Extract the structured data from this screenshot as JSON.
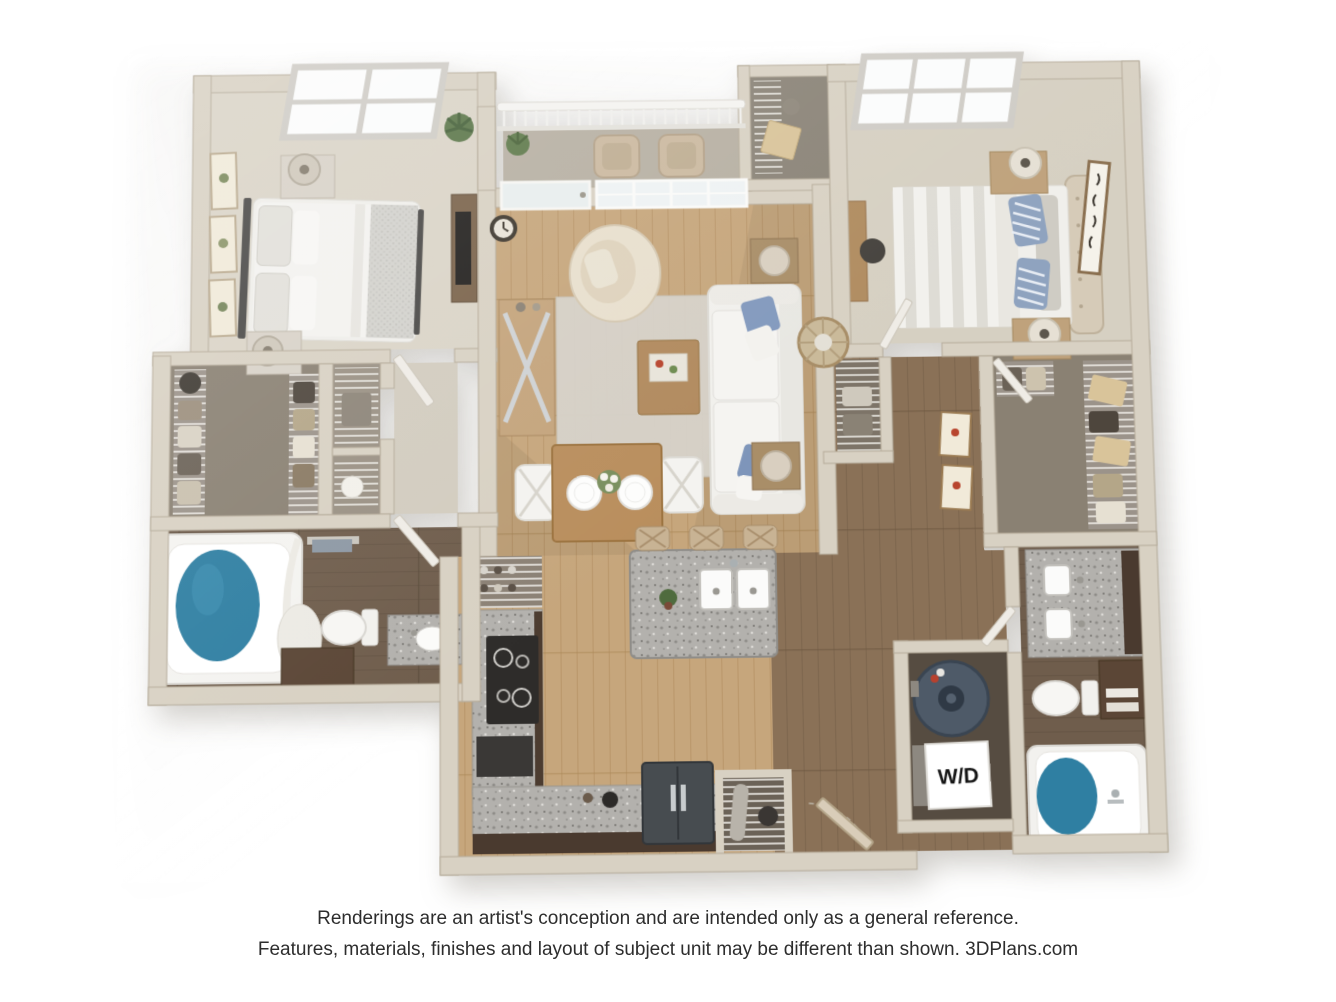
{
  "disclaimer": {
    "line1": "Renderings are an artist's conception and are intended only as a general reference.",
    "line2": "Features, materials, finishes and layout of subject unit may be different than shown. 3DPlans.com"
  },
  "labels": {
    "washer_dryer": "W/D"
  },
  "palette": {
    "background": "#ffffff",
    "wall": "#d8d1c3",
    "wall_edge": "#b5ab9a",
    "carpet_bedroom": "#dad4c7",
    "carpet_closet": "#8a8173",
    "wood_floor": "#c6a67c",
    "wood_floor_dark": "#8a7157",
    "bath_tile": "#6f5d4c",
    "granite": "#b3b1ad",
    "cabinet_dark": "#4c3c30",
    "tub_water": "#2f7fa2",
    "pillow_blue": "#8299bd",
    "balcony_floor": "#b7b0a3",
    "glass": "#f3f7f7",
    "text": "#2d2d2d"
  }
}
